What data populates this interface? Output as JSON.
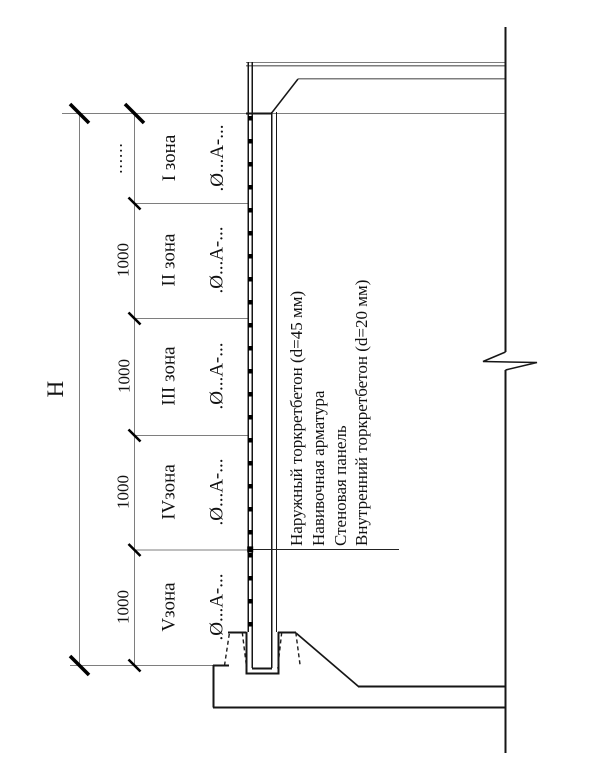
{
  "drawing": {
    "overall_height_label": "H",
    "zone_pitch_label": "1000",
    "undimensioned_dots": "......",
    "zones": [
      {
        "name": "I зона",
        "rebar_spec": ".Ø...А-..."
      },
      {
        "name": "II зона",
        "rebar_spec": ".Ø...А-..."
      },
      {
        "name": "III зона",
        "rebar_spec": ".Ø...А-..."
      },
      {
        "name": "IVзона",
        "rebar_spec": ".Ø...А-..."
      },
      {
        "name": "Vзона",
        "rebar_spec": ".Ø...А-..."
      }
    ],
    "callouts": [
      "Наружный торкретбетон (d=45 мм)",
      "Навивочная арматура",
      "Стеновая панель",
      "Внутренний торкретбетон (d=20 мм)"
    ]
  }
}
